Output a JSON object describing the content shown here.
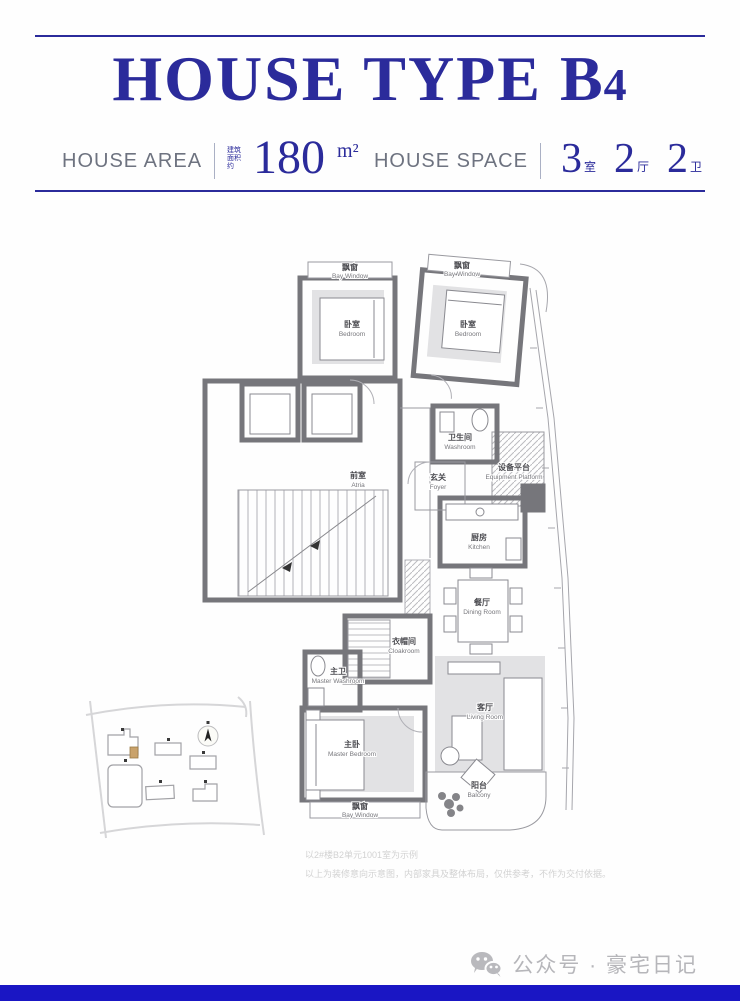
{
  "header": {
    "title_main": "HOUSE TYPE",
    "title_code_letter": "B",
    "title_code_digit": "4",
    "area_label": "HOUSE AREA",
    "area_note": "建筑面积约",
    "area_value": "180",
    "area_unit": "m²",
    "space_label": "HOUSE SPACE",
    "space": [
      {
        "num": "3",
        "unit": "室"
      },
      {
        "num": "2",
        "unit": "厅"
      },
      {
        "num": "2",
        "unit": "卫"
      }
    ]
  },
  "floorplan": {
    "rooms": [
      {
        "id": "bay-window-left",
        "cn": "飘窗",
        "en": "Bay Window"
      },
      {
        "id": "bay-window-right",
        "cn": "飘窗",
        "en": "Bay Window"
      },
      {
        "id": "bedroom-left",
        "cn": "卧室",
        "en": "Bedroom"
      },
      {
        "id": "bedroom-right",
        "cn": "卧室",
        "en": "Bedroom"
      },
      {
        "id": "washroom",
        "cn": "卫生间",
        "en": "Washroom"
      },
      {
        "id": "atria",
        "cn": "前室",
        "en": "Atria"
      },
      {
        "id": "foyer",
        "cn": "玄关",
        "en": "Foyer"
      },
      {
        "id": "equipment-platform",
        "cn": "设备平台",
        "en": "Equipment Platform"
      },
      {
        "id": "kitchen",
        "cn": "厨房",
        "en": "Kitchen"
      },
      {
        "id": "dining-room",
        "cn": "餐厅",
        "en": "Dining Room"
      },
      {
        "id": "cloakroom",
        "cn": "衣帽间",
        "en": "Cloakroom"
      },
      {
        "id": "master-washroom",
        "cn": "主卫",
        "en": "Master Washroom"
      },
      {
        "id": "living-room",
        "cn": "客厅",
        "en": "Living Room"
      },
      {
        "id": "master-bedroom",
        "cn": "主卧",
        "en": "Master Bedroom"
      },
      {
        "id": "balcony",
        "cn": "阳台",
        "en": "Balcony"
      },
      {
        "id": "bay-window-bottom",
        "cn": "飘窗",
        "en": "Bay Window"
      }
    ]
  },
  "disclaimer": {
    "line1": "以2#楼B2单元1001室为示例",
    "line2": "以上为装修意向示意图，内部家具及整体布局，仅供参考，不作为交付依据。"
  },
  "footer": {
    "account": "公众号 · 豪宅日记"
  },
  "colors": {
    "accent_navy": "#2b2b9b",
    "bottom_bar_blue": "#1a16c4",
    "wall_gray": "#76767b",
    "furniture_gray": "#e2e2e4",
    "site_highlight_tan": "#c9a26b",
    "header_label_gray": "#6e7380",
    "disclaimer_gray": "#d2d2d2",
    "footer_gray": "#b6b6ba"
  }
}
